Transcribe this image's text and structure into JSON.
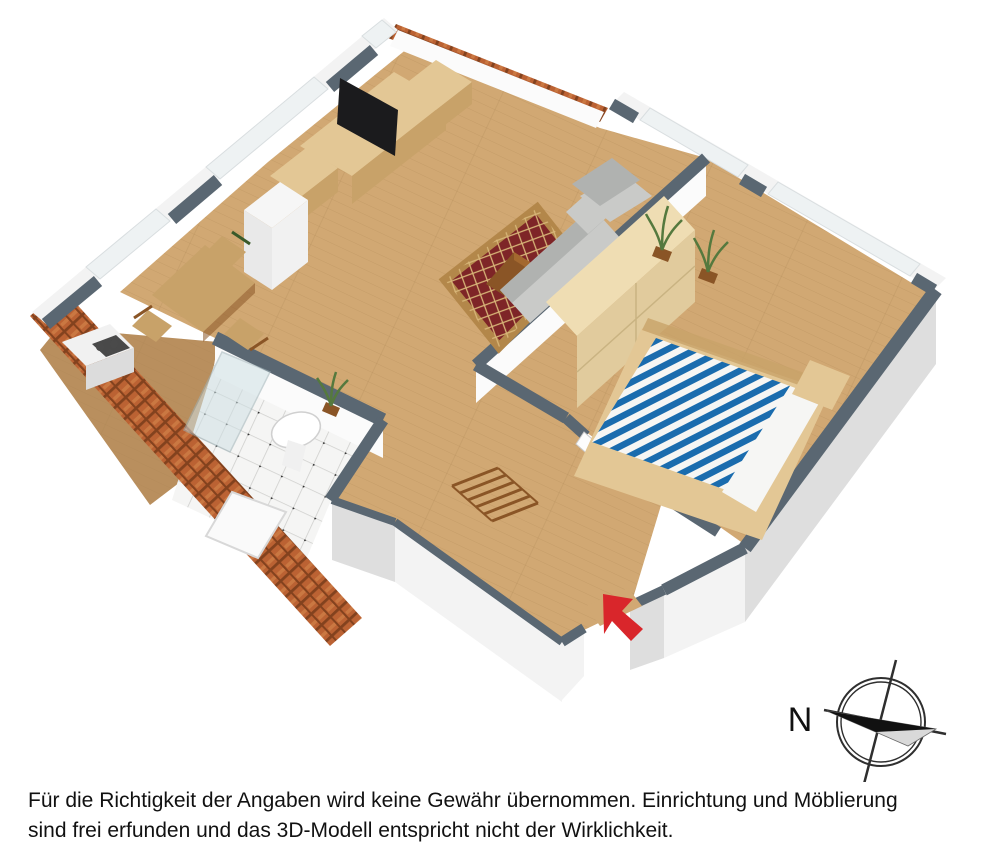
{
  "scene": {
    "compass": {
      "label": "N"
    },
    "disclaimer": {
      "line1": "Für die Richtigkeit der Angaben wird keine Gewähr übernommen. Einrichtung und Möblierung",
      "line2": "sind frei erfunden und das 3D-Modell entspricht nicht der Wirklichkeit."
    },
    "palette": {
      "background": "#ffffff",
      "wall_cap": "#5a6772",
      "wall_face": "#f3f3f3",
      "wall_face_shade": "#dedede",
      "wall_inner": "#fbfbfb",
      "glass": "#eef2f3",
      "floor_wood": "#d1a873",
      "floor_wood_line": "#a9814e",
      "floor_kitchen": "#b98f5e",
      "bath_tile": "#f5f5f4",
      "bath_tile_line": "#cfcfcd",
      "bath_tile_dot": "#2e2e2e",
      "roof_tile": "#bb6233",
      "roof_tile_dark": "#83421e",
      "roof_tile_light": "#d98d52",
      "rug_field": "#7e2527",
      "rug_border": "#b3874a",
      "rug_line": "#d8b678",
      "bed_blue": "#1a6cae",
      "bed_white": "#f6f6f4",
      "wood_light": "#e3c795",
      "wood_mid": "#c8a269",
      "wood_dark": "#8a5526",
      "cream": "#efddb3",
      "cream_face": "#e1cb9d",
      "sofa": "#c9cac8",
      "sofa_dark": "#b0b2b0",
      "plant": "#55793e",
      "plant_dark": "#3a5a2a",
      "appliance": "#f1f1f1",
      "appliance_dark": "#2b2b2b",
      "arrow_red": "#d9262b",
      "compass_ink": "#2f2f2f",
      "ink": "#111111"
    }
  }
}
